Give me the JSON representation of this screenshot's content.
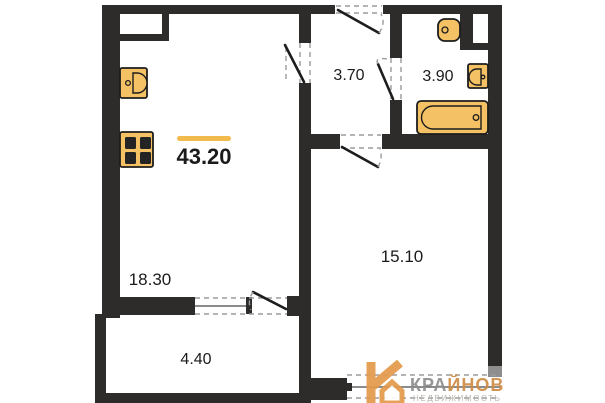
{
  "plan": {
    "title": "apartment-floor-plan",
    "rooms": {
      "total": {
        "label": "total-area",
        "area": "43.20"
      },
      "living": {
        "label": "living-room",
        "area": "18.30"
      },
      "hallway": {
        "label": "hallway",
        "area": "3.70"
      },
      "bathroom": {
        "label": "bathroom",
        "area": "3.90"
      },
      "bedroom": {
        "label": "bedroom",
        "area": "15.10"
      },
      "balcony": {
        "label": "balcony",
        "area": "4.40"
      }
    },
    "fixtures": [
      "kitchen-sink-icon",
      "stove-icon",
      "toilet-icon",
      "bathroom-sink-icon",
      "bathtub-icon"
    ],
    "doors": [
      "entrance-door",
      "living-room-door",
      "bathroom-door",
      "bedroom-door",
      "balcony-door"
    ],
    "windows": [
      "balcony-window",
      "bedroom-window"
    ]
  },
  "watermark": {
    "brand_part1": "КРА",
    "brand_part2": "ЙНОВ",
    "tagline": "НЕДВИЖИМОСТЬ"
  },
  "colors": {
    "wall": "#2e2c2b",
    "fixture": "#f4c164",
    "fixture-stroke": "#1d1d1d",
    "accent": "#f2ba4c",
    "dash": "#9b9b9b",
    "cap": "#8e8e8e",
    "logo": "#e49a4a",
    "brand-grey": "#8e8e8e",
    "brand-orange": "#cf8c45",
    "tagline": "#b6b1ac",
    "label": "#1b1b1b"
  }
}
